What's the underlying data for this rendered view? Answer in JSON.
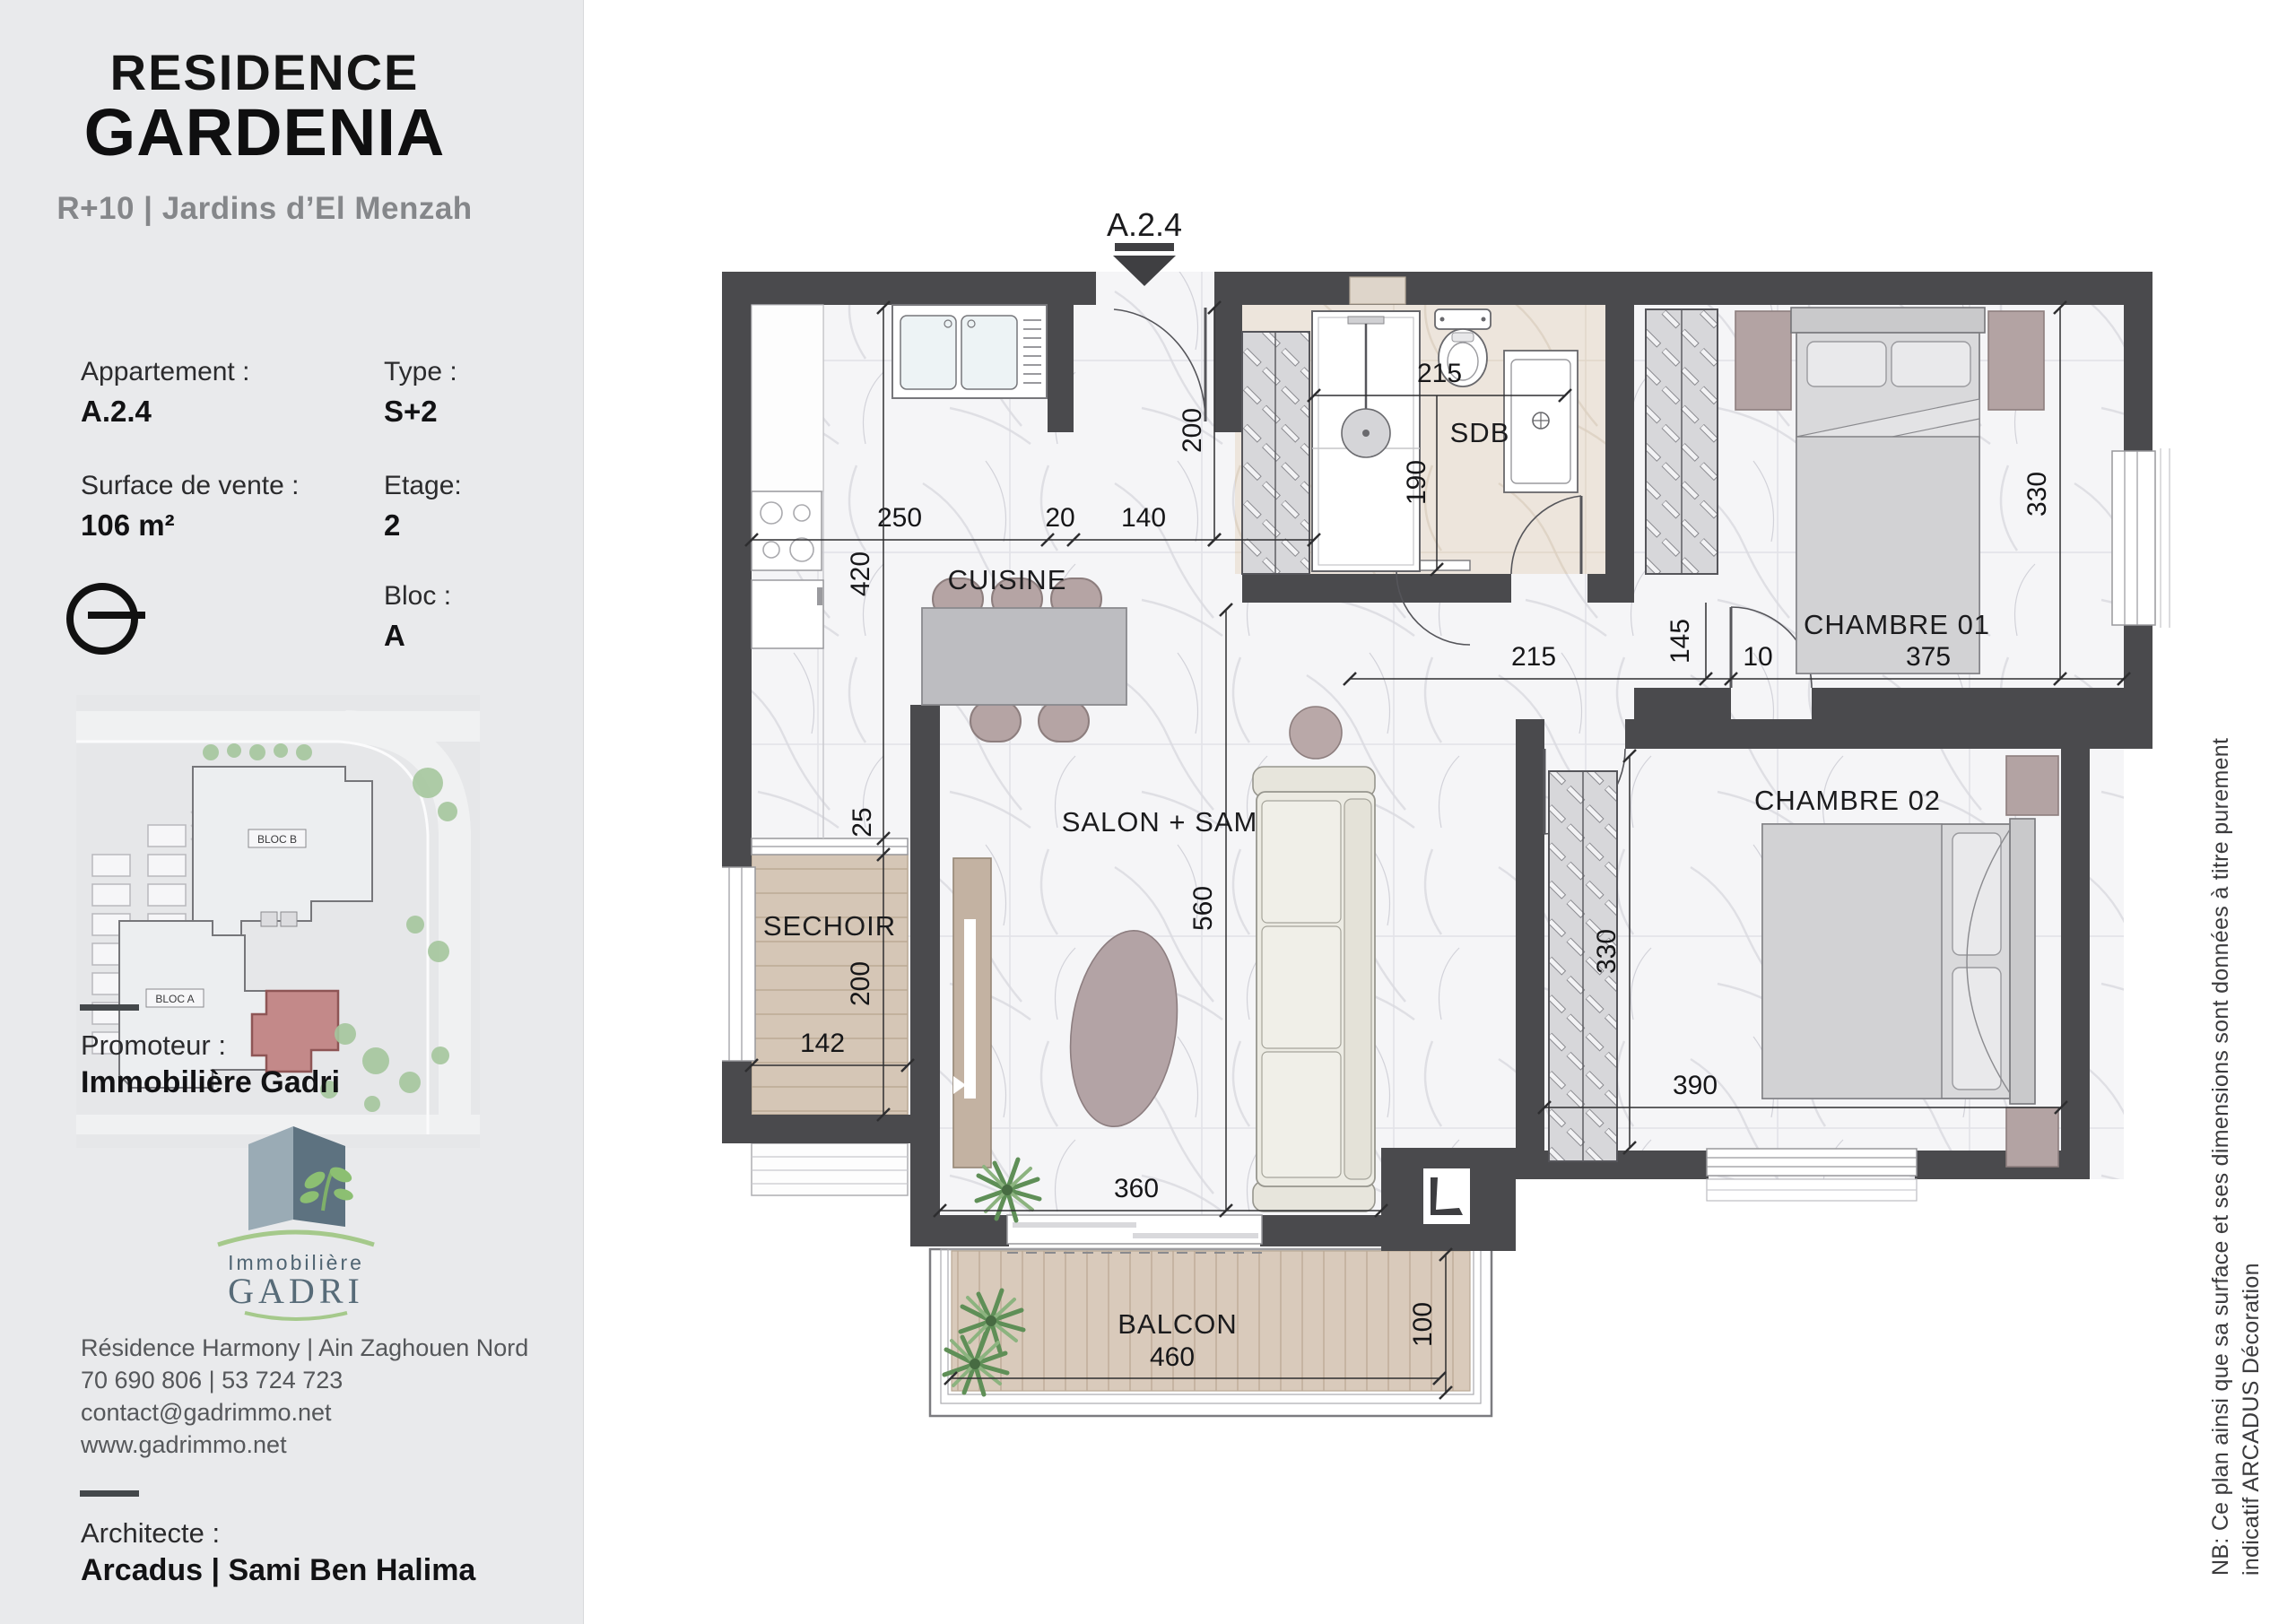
{
  "sidebar": {
    "title_line1": "RESIDENCE",
    "title_line2": "GARDENIA",
    "subtitle": "R+10 | Jardins d’El Menzah",
    "fields": {
      "appartement_label": "Appartement :",
      "appartement_value": "A.2.4",
      "type_label": "Type :",
      "type_value": "S+2",
      "surface_label": "Surface de vente :",
      "surface_value": "106 m²",
      "etage_label": "Etage:",
      "etage_value": "2",
      "bloc_label": "Bloc :",
      "bloc_value": "A"
    },
    "site_plan": {
      "bloc_a": "BLOC A",
      "bloc_b": "BLOC B"
    },
    "promoteur_label": "Promoteur :",
    "promoteur_value": "Immobilière Gadri",
    "logo": {
      "line1": "Immobilière",
      "line2": "GADRI"
    },
    "contact": {
      "line1": "Résidence Harmony | Ain Zaghouen Nord",
      "line2": "70 690 806  | 53 724 723",
      "line3": "contact@gadrimmo.net",
      "line4": "www.gadrimmo.net"
    },
    "architecte_label": "Architecte :",
    "architecte_value": "Arcadus | Sami Ben Halima"
  },
  "plan": {
    "unit": "A.2.4",
    "rooms": {
      "cuisine": "CUISINE",
      "sdb": "SDB",
      "chambre1": "CHAMBRE 01",
      "chambre2": "CHAMBRE 02",
      "salon": "SALON + SAM",
      "sechoir": "SECHOIR",
      "balcon": "BALCON"
    },
    "dims": {
      "cuisine_w1": "250",
      "cuisine_w2": "20",
      "cuisine_w3": "140",
      "entry_depth": "200",
      "cuisine_h": "420",
      "sechoir_top": "25",
      "sechoir_h": "200",
      "sechoir_w": "142",
      "sdb_w": "215",
      "sdb_h": "190",
      "corridor_w": "215",
      "corridor_h": "145",
      "corridor_s": "10",
      "ch1_w": "375",
      "ch1_h": "330",
      "ch2_w": "390",
      "ch2_h": "330",
      "salon_h": "560",
      "salon_w": "360",
      "balcon_w": "460",
      "balcon_h": "100"
    }
  },
  "note": {
    "line1": "NB: Ce plan ainsi que sa surface et ses dimensions sont données à titre purement",
    "line2": "indicatif ARCADUS Décoration"
  },
  "colors": {
    "wall": "#4a4a4d",
    "unit_highlight": "#c38989",
    "wood_deck": "#d5c6b6",
    "furniture_accent": "#b5a4a4",
    "logo_green": "#a5c98b",
    "logo_slate": "#5d7280"
  }
}
